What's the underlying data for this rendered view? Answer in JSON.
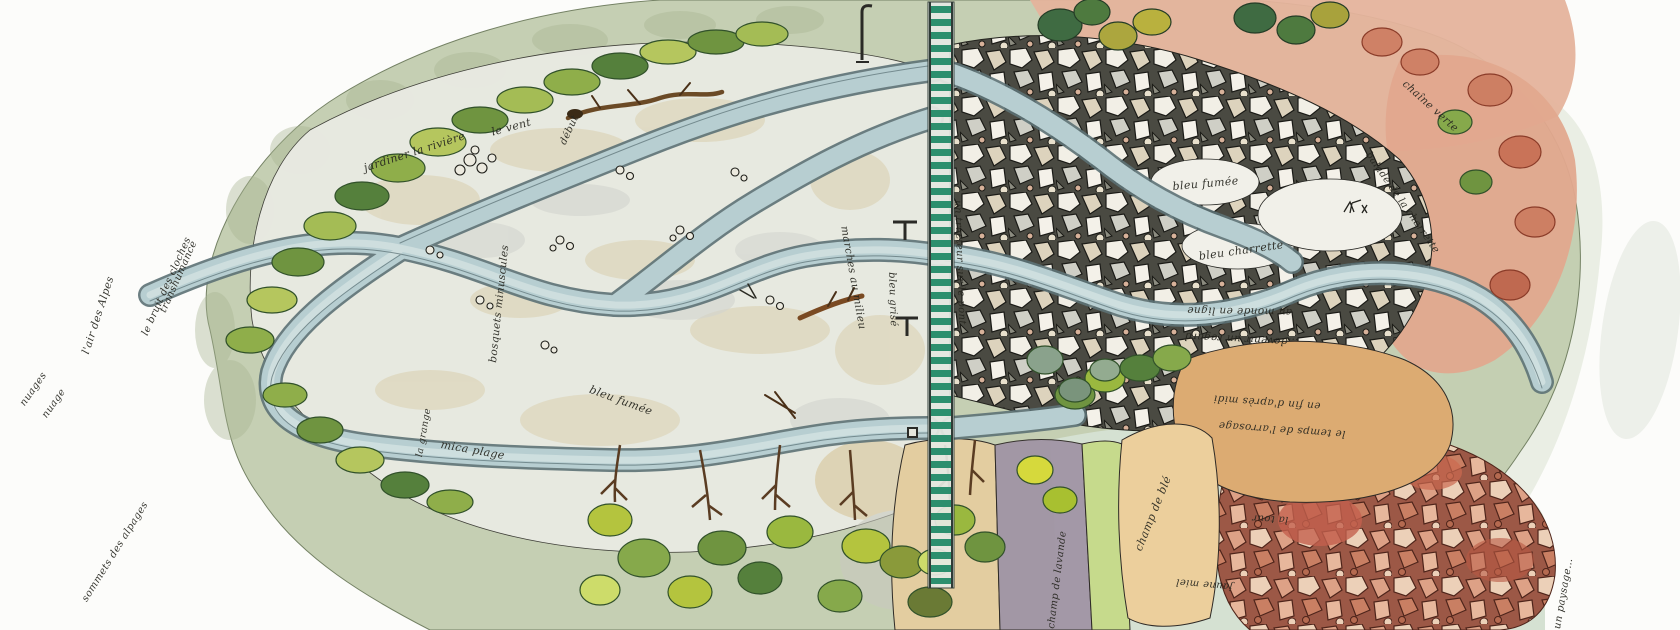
{
  "artwork": {
    "title": "Watercolor plan-view of a braided river landscape",
    "style": "ink and watercolor aerial sketch map",
    "language": "French"
  },
  "palette": {
    "paper": "#fcfcfa",
    "sage_rim": "#c3ceb1",
    "gravel": "#e9eae2",
    "beige": "#d9cdaa",
    "river": "#b7ced1",
    "river_edge": "#5d7276",
    "pebble_dark": "#4a4a42",
    "stone_light": "#f2efe6",
    "salmon": "#e5b39c",
    "coral": "#cd7f63",
    "olive": "#aca63e",
    "leaf": "#8fae4a",
    "leaf_dark": "#4e7a3f",
    "field_tan": "#eccf9c",
    "field_orange": "#dcab72",
    "field_purple": "#a195a5",
    "field_green": "#c6da8c",
    "aqua_wash": "#d5e1d2",
    "bridge_green": "#2c8f6e",
    "ink": "#23231e"
  },
  "annotations": [
    {
      "text": "jardiner la rivière",
      "x": 362,
      "y": 162,
      "rot": -18,
      "size": 11
    },
    {
      "text": "le vent",
      "x": 490,
      "y": 126,
      "rot": -15,
      "size": 11
    },
    {
      "text": "début",
      "x": 558,
      "y": 142,
      "rot": -65,
      "size": 10
    },
    {
      "text": "bosquets minuscules",
      "x": 487,
      "y": 362,
      "rot": -84,
      "size": 10.5
    },
    {
      "text": "mica plage",
      "x": 442,
      "y": 438,
      "rot": 10,
      "size": 11
    },
    {
      "text": "la grange",
      "x": 414,
      "y": 456,
      "rot": -80,
      "size": 9.5
    },
    {
      "text": "bleu fumée",
      "x": 592,
      "y": 383,
      "rot": 20,
      "size": 11
    },
    {
      "text": "marches au milieu",
      "x": 850,
      "y": 225,
      "rot": 80,
      "size": 10.5
    },
    {
      "text": "bleu grisé",
      "x": 897,
      "y": 272,
      "rot": 88,
      "size": 10
    },
    {
      "text": "un tracteur sur le pont",
      "x": 963,
      "y": 200,
      "rot": 88,
      "size": 10
    },
    {
      "text": "bleu fumée",
      "x": 1172,
      "y": 180,
      "rot": -5,
      "size": 11
    },
    {
      "text": "bleu charrette",
      "x": 1198,
      "y": 250,
      "rot": -8,
      "size": 11
    },
    {
      "text": "au monde en ligne",
      "x": 1292,
      "y": 318,
      "rot": 181,
      "size": 10.5
    },
    {
      "text": "…devenir un regard",
      "x": 1298,
      "y": 348,
      "rot": 183,
      "size": 10.5
    },
    {
      "text": "en fin d'après midi",
      "x": 1320,
      "y": 412,
      "rot": 184,
      "size": 10.5
    },
    {
      "text": "le temps de l'arrosage",
      "x": 1345,
      "y": 440,
      "rot": 184,
      "size": 10.5
    },
    {
      "text": "champ de blé",
      "x": 1132,
      "y": 548,
      "rot": -68,
      "size": 11
    },
    {
      "text": "champ de lavande",
      "x": 1046,
      "y": 628,
      "rot": -83,
      "size": 10
    },
    {
      "text": "la tour",
      "x": 1288,
      "y": 525,
      "rot": 183,
      "size": 10
    },
    {
      "text": "jaune miel",
      "x": 1232,
      "y": 592,
      "rot": 185,
      "size": 10
    },
    {
      "text": "chaîne verte",
      "x": 1408,
      "y": 78,
      "rot": 42,
      "size": 10.5
    },
    {
      "text": "balade de la charrette",
      "x": 1372,
      "y": 150,
      "rot": 55,
      "size": 10
    },
    {
      "text": "nuages",
      "x": 18,
      "y": 402,
      "rot": -55,
      "size": 10
    },
    {
      "text": "nuage",
      "x": 40,
      "y": 414,
      "rot": -55,
      "size": 10
    },
    {
      "text": "l'air des Alpes",
      "x": 80,
      "y": 352,
      "rot": -72,
      "size": 10.5
    },
    {
      "text": "le bruit des cloches",
      "x": 140,
      "y": 333,
      "rot": -66,
      "size": 10
    },
    {
      "text": "transhumance",
      "x": 158,
      "y": 310,
      "rot": -66,
      "size": 10
    },
    {
      "text": "sommets des alpages",
      "x": 80,
      "y": 598,
      "rot": -58,
      "size": 10
    },
    {
      "text": "un paysage…",
      "x": 1552,
      "y": 628,
      "rot": -80,
      "size": 10
    }
  ]
}
